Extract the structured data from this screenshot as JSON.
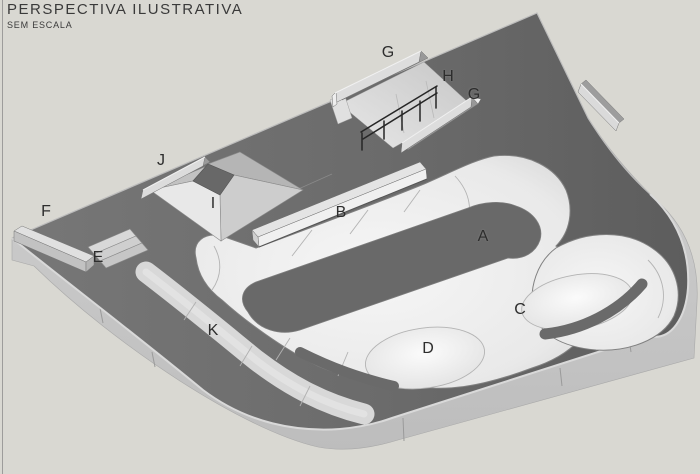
{
  "header": {
    "title": "PERSPECTIVA ILUSTRATIVA",
    "subtitle": "SEM ESCALA"
  },
  "figure": {
    "type": "3d-perspective-illustration",
    "subject": "skatepark-concrete-plaza",
    "labels": [
      {
        "text": "A",
        "x": 483,
        "y": 237
      },
      {
        "text": "B",
        "x": 341,
        "y": 213
      },
      {
        "text": "C",
        "x": 520,
        "y": 310
      },
      {
        "text": "D",
        "x": 428,
        "y": 349
      },
      {
        "text": "E",
        "x": 98,
        "y": 258
      },
      {
        "text": "F",
        "x": 46,
        "y": 212
      },
      {
        "text": "G",
        "x": 388,
        "y": 53
      },
      {
        "text": "G",
        "x": 474,
        "y": 95
      },
      {
        "text": "H",
        "x": 448,
        "y": 77
      },
      {
        "text": "I",
        "x": 213,
        "y": 204
      },
      {
        "text": "J",
        "x": 161,
        "y": 161
      },
      {
        "text": "K",
        "x": 213,
        "y": 331
      }
    ],
    "palette": {
      "background": "#d9d8d2",
      "deck_concrete": "#6b6b6b",
      "deck_light": "#767676",
      "deck_dark": "#5e5e5e",
      "side_face": "#c8c8c8",
      "bowl_surface": "#f2f2f2",
      "bowl_edge": "#d3d3d3",
      "ledge_light": "#e0e0e0",
      "handrail": "#262626",
      "label_color": "#2d2d2d",
      "title_color": "#3a3a3a"
    }
  }
}
